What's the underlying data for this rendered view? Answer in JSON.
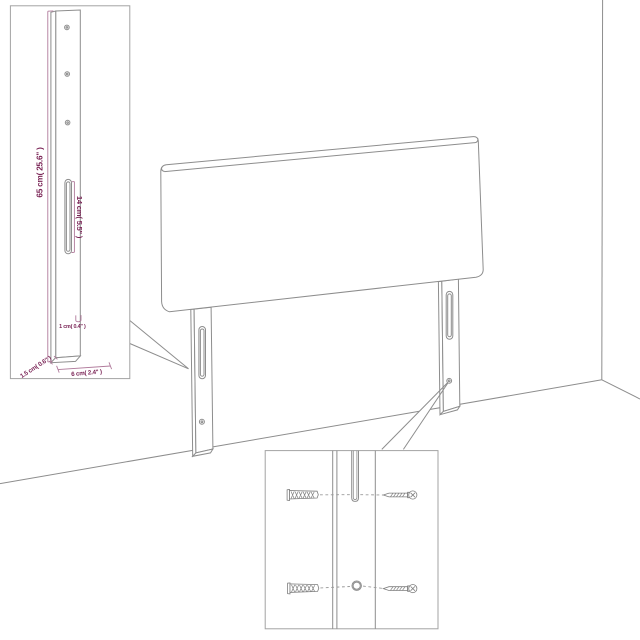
{
  "diagram": {
    "kind": "furniture-assembly-diagram",
    "subject": "headboard-with-legs-against-wall-corner",
    "colors": {
      "background": "#ffffff",
      "line": "#8d8d8d",
      "inset_border": "#a3a3a3",
      "dimension_text": "#7a2456",
      "dimension_line": "#b07a9b"
    },
    "dims": {
      "height": "65 cm( 25.6\" )",
      "slot_length": "14 cm( 5.5\" )",
      "thickness": "1 cm( 0.4\" )",
      "side_depth": "1.5 cm( 0.6\" )",
      "foot_width": "6 cm( 2.4\" )"
    },
    "icons": [
      "leg-detail-inset",
      "mounting-detail-inset",
      "wall-plug-icon",
      "screw-icon",
      "mounting-slot",
      "screw-hole"
    ]
  }
}
